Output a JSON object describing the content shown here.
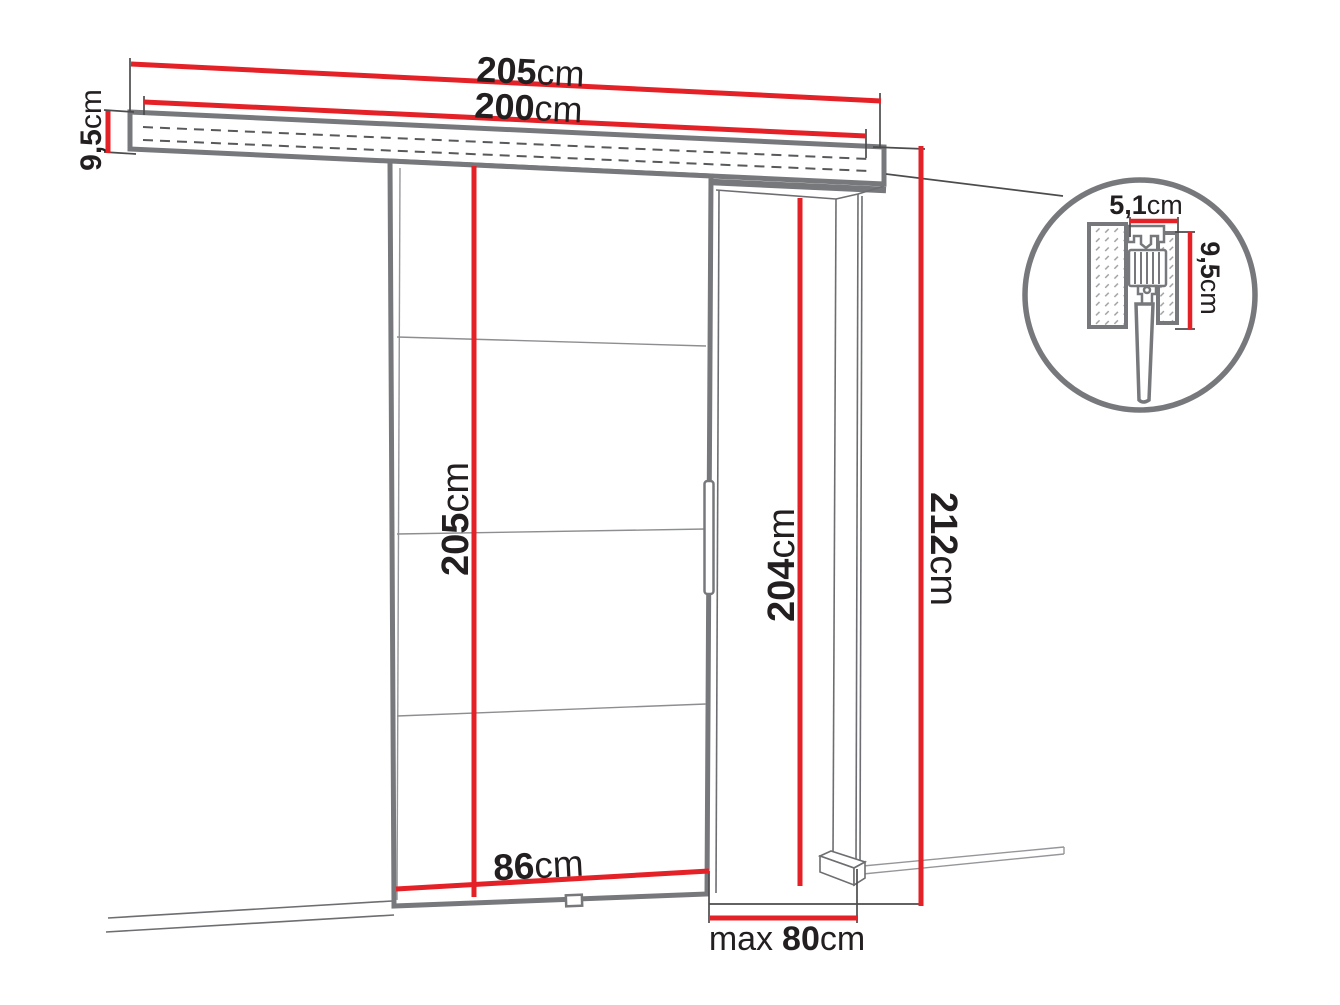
{
  "diagram": {
    "name": "Sliding door system dimension diagram",
    "colors": {
      "dimension_red": "#e32126",
      "outline_gray": "#77787b",
      "sketch_gray": "#6d6e71",
      "text_black": "#231f20"
    },
    "labels": {
      "track_total_width": {
        "value": "205",
        "unit": "cm"
      },
      "track_length": {
        "value": "200",
        "unit": "cm"
      },
      "track_height": {
        "value": "9,5",
        "unit": "cm"
      },
      "door_height": {
        "value": "205",
        "unit": "cm"
      },
      "door_width": {
        "value": "86",
        "unit": "cm"
      },
      "opening_height": {
        "value": "204",
        "unit": "cm"
      },
      "system_height": {
        "value": "212",
        "unit": "cm"
      },
      "opening_max_width": {
        "prefix": "max",
        "value": "80",
        "unit": "cm"
      },
      "detail_track_width": {
        "value": "5,1",
        "unit": "cm"
      },
      "detail_track_height": {
        "value": "9,5",
        "unit": "cm"
      }
    }
  }
}
